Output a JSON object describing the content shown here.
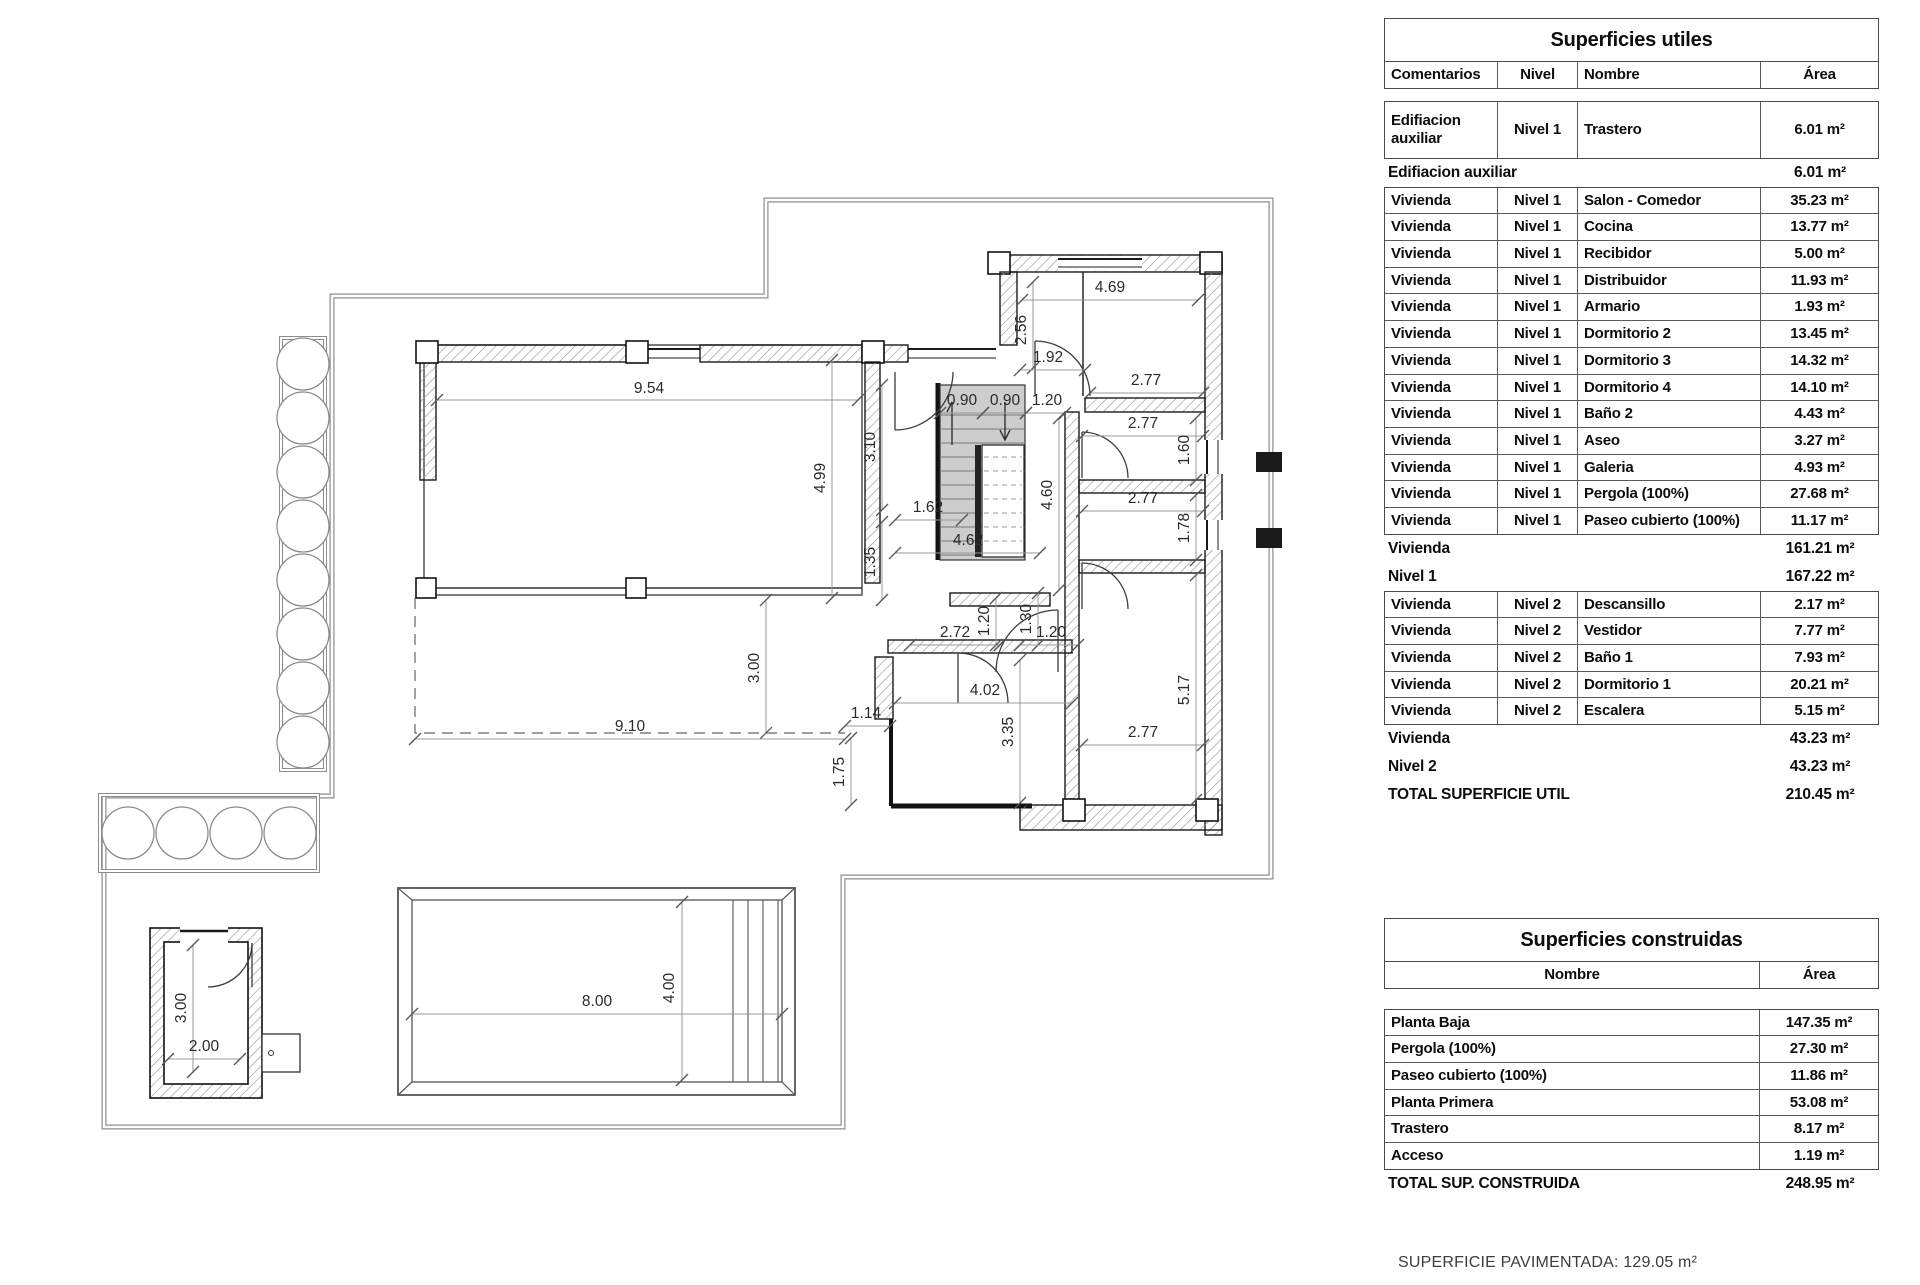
{
  "tables": {
    "utiles": {
      "title": "Superficies utiles",
      "headers": [
        "Comentarios",
        "Nivel",
        "Nombre",
        "Área"
      ],
      "group1_rows": [
        {
          "comentarios": "Edifiacion auxiliar",
          "nivel": "Nivel 1",
          "nombre": "Trastero",
          "area": "6.01 m²"
        }
      ],
      "subtotal1": [
        {
          "label": "Edifiacion auxiliar",
          "value": "6.01 m²"
        }
      ],
      "group2_rows": [
        {
          "comentarios": "Vivienda",
          "nivel": "Nivel 1",
          "nombre": "Salon - Comedor",
          "area": "35.23 m²"
        },
        {
          "comentarios": "Vivienda",
          "nivel": "Nivel 1",
          "nombre": "Cocina",
          "area": "13.77 m²"
        },
        {
          "comentarios": "Vivienda",
          "nivel": "Nivel 1",
          "nombre": "Recibidor",
          "area": "5.00 m²"
        },
        {
          "comentarios": "Vivienda",
          "nivel": "Nivel 1",
          "nombre": "Distribuidor",
          "area": "11.93 m²"
        },
        {
          "comentarios": "Vivienda",
          "nivel": "Nivel 1",
          "nombre": "Armario",
          "area": "1.93 m²"
        },
        {
          "comentarios": "Vivienda",
          "nivel": "Nivel 1",
          "nombre": "Dormitorio 2",
          "area": "13.45 m²"
        },
        {
          "comentarios": "Vivienda",
          "nivel": "Nivel 1",
          "nombre": "Dormitorio 3",
          "area": "14.32 m²"
        },
        {
          "comentarios": "Vivienda",
          "nivel": "Nivel 1",
          "nombre": "Dormitorio 4",
          "area": "14.10 m²"
        },
        {
          "comentarios": "Vivienda",
          "nivel": "Nivel 1",
          "nombre": "Baño 2",
          "area": "4.43 m²"
        },
        {
          "comentarios": "Vivienda",
          "nivel": "Nivel 1",
          "nombre": "Aseo",
          "area": "3.27 m²"
        },
        {
          "comentarios": "Vivienda",
          "nivel": "Nivel 1",
          "nombre": "Galeria",
          "area": "4.93 m²"
        },
        {
          "comentarios": "Vivienda",
          "nivel": "Nivel 1",
          "nombre": "Pergola (100%)",
          "area": "27.68 m²"
        },
        {
          "comentarios": "Vivienda",
          "nivel": "Nivel 1",
          "nombre": "Paseo cubierto (100%)",
          "area": "11.17 m²"
        }
      ],
      "subtotal2": [
        {
          "label": "Vivienda",
          "value": "161.21 m²"
        },
        {
          "label": "Nivel 1",
          "value": "167.22 m²"
        }
      ],
      "group3_rows": [
        {
          "comentarios": "Vivienda",
          "nivel": "Nivel 2",
          "nombre": "Descansillo",
          "area": "2.17 m²"
        },
        {
          "comentarios": "Vivienda",
          "nivel": "Nivel 2",
          "nombre": "Vestidor",
          "area": "7.77 m²"
        },
        {
          "comentarios": "Vivienda",
          "nivel": "Nivel 2",
          "nombre": "Baño 1",
          "area": "7.93 m²"
        },
        {
          "comentarios": "Vivienda",
          "nivel": "Nivel 2",
          "nombre": "Dormitorio 1",
          "area": "20.21 m²"
        },
        {
          "comentarios": "Vivienda",
          "nivel": "Nivel 2",
          "nombre": "Escalera",
          "area": "5.15 m²"
        }
      ],
      "subtotal3": [
        {
          "label": "Vivienda",
          "value": "43.23 m²"
        },
        {
          "label": "Nivel 2",
          "value": "43.23 m²"
        },
        {
          "label": "TOTAL SUPERFICIE UTIL",
          "value": "210.45 m²"
        }
      ]
    },
    "construidas": {
      "title": "Superficies construidas",
      "headers": [
        "Nombre",
        "Área"
      ],
      "rows": [
        {
          "nombre": "Planta Baja",
          "area": "147.35 m²"
        },
        {
          "nombre": "Pergola (100%)",
          "area": "27.30 m²"
        },
        {
          "nombre": "Paseo cubierto (100%)",
          "area": "11.86 m²"
        },
        {
          "nombre": "Planta Primera",
          "area": "53.08 m²"
        },
        {
          "nombre": "Trastero",
          "area": "8.17 m²"
        },
        {
          "nombre": "Acceso",
          "area": "1.19 m²"
        }
      ],
      "total": [
        {
          "label": "TOTAL SUP. CONSTRUIDA",
          "value": "248.95 m²"
        }
      ]
    }
  },
  "footer": {
    "text": "SUPERFICIE PAVIMENTADA: 129.05 m²"
  },
  "plan": {
    "colors": {
      "wall_hatch": "#9a9a9a",
      "boundary": "#8c8c8c",
      "stairs_fill": "#cdcdcd",
      "dim_line": "#999999",
      "label": "#2b2b2b"
    },
    "dimensions": [
      {
        "t": "9.54",
        "x": 649,
        "y": 393,
        "r": 0,
        "l": [
          437,
          400,
          858,
          400
        ]
      },
      {
        "t": "4.69",
        "x": 1110,
        "y": 292,
        "r": 0,
        "l": [
          1022,
          300,
          1198,
          300
        ]
      },
      {
        "t": "2.56",
        "x": 1026,
        "y": 330,
        "r": 90,
        "l": [
          1033,
          282,
          1033,
          368
        ]
      },
      {
        "t": "1.92",
        "x": 1048,
        "y": 362,
        "r": 0,
        "l": [
          1020,
          370,
          1085,
          370
        ]
      },
      {
        "t": "2.77",
        "x": 1146,
        "y": 385,
        "r": 0,
        "l": [
          1090,
          393,
          1203,
          393
        ]
      },
      {
        "t": "0.90",
        "x": 962,
        "y": 405,
        "r": 0,
        "l": [
          940,
          413,
          983,
          413
        ]
      },
      {
        "t": "0.90",
        "x": 1005,
        "y": 405,
        "r": 0,
        "l": [
          983,
          413,
          1026,
          413
        ]
      },
      {
        "t": "1.20",
        "x": 1047,
        "y": 405,
        "r": 0,
        "l": [
          1026,
          413,
          1065,
          413
        ]
      },
      {
        "t": "2.77",
        "x": 1143,
        "y": 428,
        "r": 0,
        "l": [
          1082,
          436,
          1203,
          436
        ]
      },
      {
        "t": "1.60",
        "x": 1189,
        "y": 450,
        "r": 90,
        "l": [
          1196,
          418,
          1196,
          480
        ]
      },
      {
        "t": "2.77",
        "x": 1143,
        "y": 503,
        "r": 0,
        "l": [
          1082,
          511,
          1203,
          511
        ]
      },
      {
        "t": "1.78",
        "x": 1189,
        "y": 528,
        "r": 90,
        "l": [
          1196,
          495,
          1196,
          560
        ]
      },
      {
        "t": "4.60",
        "x": 1052,
        "y": 495,
        "r": 90,
        "l": [
          1059,
          418,
          1059,
          590
        ]
      },
      {
        "t": "3.10",
        "x": 875,
        "y": 447,
        "r": 90,
        "l": [
          882,
          385,
          882,
          510
        ]
      },
      {
        "t": "4.99",
        "x": 825,
        "y": 478,
        "r": 90,
        "l": [
          832,
          360,
          832,
          598
        ]
      },
      {
        "t": "1.62",
        "x": 928,
        "y": 512,
        "r": 0,
        "l": [
          895,
          520,
          962,
          520
        ]
      },
      {
        "t": "4.62",
        "x": 968,
        "y": 545,
        "r": 0,
        "l": [
          895,
          553,
          1040,
          553
        ]
      },
      {
        "t": "1.35",
        "x": 875,
        "y": 562,
        "r": 90,
        "l": [
          882,
          522,
          882,
          600
        ]
      },
      {
        "t": "2.72",
        "x": 955,
        "y": 637,
        "r": 0,
        "l": [
          910,
          645,
          1000,
          645
        ]
      },
      {
        "t": "1.20",
        "x": 989,
        "y": 621,
        "r": 90,
        "l": [
          996,
          598,
          996,
          645
        ]
      },
      {
        "t": "1.30",
        "x": 1031,
        "y": 619,
        "r": 90,
        "l": [
          1038,
          593,
          1038,
          645
        ]
      },
      {
        "t": "1.20",
        "x": 1051,
        "y": 637,
        "r": 0,
        "l": [
          1020,
          645,
          1078,
          645
        ]
      },
      {
        "t": "4.02",
        "x": 985,
        "y": 695,
        "r": 0,
        "l": [
          895,
          703,
          1072,
          703
        ]
      },
      {
        "t": "3.35",
        "x": 1013,
        "y": 732,
        "r": 90,
        "l": [
          1020,
          660,
          1020,
          803
        ]
      },
      {
        "t": "2.77",
        "x": 1143,
        "y": 737,
        "r": 0,
        "l": [
          1082,
          745,
          1203,
          745
        ]
      },
      {
        "t": "5.17",
        "x": 1189,
        "y": 690,
        "r": 90,
        "l": [
          1196,
          575,
          1196,
          800
        ]
      },
      {
        "t": "1.14",
        "x": 866,
        "y": 718,
        "r": 0,
        "l": [
          845,
          726,
          890,
          726
        ]
      },
      {
        "t": "1.75",
        "x": 844,
        "y": 772,
        "r": 90,
        "l": [
          851,
          738,
          851,
          805
        ]
      },
      {
        "t": "3.00",
        "x": 759,
        "y": 668,
        "r": 90,
        "l": [
          766,
          600,
          766,
          733
        ]
      },
      {
        "t": "9.10",
        "x": 630,
        "y": 731,
        "r": 0,
        "l": [
          415,
          739,
          845,
          739
        ]
      },
      {
        "t": "8.00",
        "x": 597,
        "y": 1006,
        "r": 0,
        "l": [
          412,
          1014,
          782,
          1014
        ]
      },
      {
        "t": "4.00",
        "x": 674,
        "y": 988,
        "r": 90,
        "l": [
          682,
          902,
          682,
          1080
        ]
      },
      {
        "t": "3.00",
        "x": 186,
        "y": 1008,
        "r": 90,
        "l": [
          193,
          945,
          193,
          1072
        ]
      },
      {
        "t": "2.00",
        "x": 204,
        "y": 1051,
        "r": 0,
        "l": [
          168,
          1059,
          240,
          1059
        ]
      }
    ]
  }
}
